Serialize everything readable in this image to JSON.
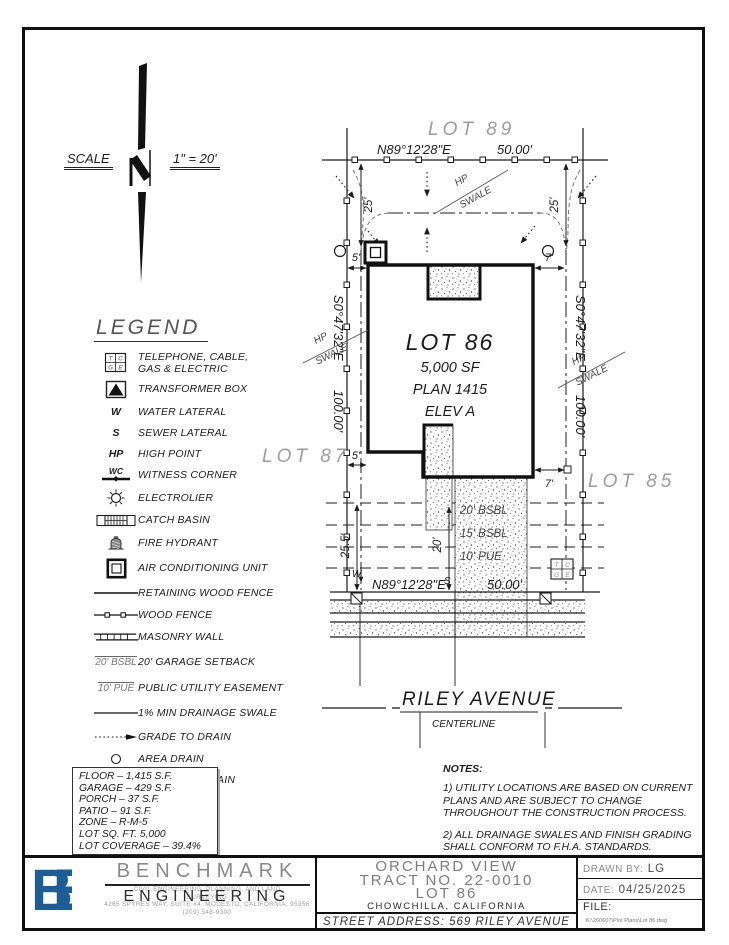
{
  "scale": {
    "label": "SCALE",
    "value": "1\" = 20'"
  },
  "legend": {
    "title": "LEGEND",
    "items": [
      {
        "sym": [
          "T",
          "C",
          "G",
          "E"
        ],
        "label": "TELEPHONE, CABLE,\nGAS & ELECTRIC"
      },
      {
        "label": "TRANSFORMER BOX"
      },
      {
        "symbol": "W",
        "label": "WATER LATERAL"
      },
      {
        "symbol": "S",
        "label": "SEWER LATERAL"
      },
      {
        "symbol": "HP",
        "label": "HIGH POINT"
      },
      {
        "symbol": "WC",
        "label": "WITNESS CORNER"
      },
      {
        "label": "ELECTROLIER"
      },
      {
        "label": "CATCH BASIN"
      },
      {
        "label": "FIRE HYDRANT"
      },
      {
        "label": "AIR CONDITIONING UNIT"
      },
      {
        "label": "RETAINING WOOD FENCE"
      },
      {
        "label": "WOOD FENCE"
      },
      {
        "label": "MASONRY WALL"
      },
      {
        "symbol": "20' BSBL",
        "label": "20' GARAGE SETBACK"
      },
      {
        "symbol": "10' PUE",
        "label": "PUBLIC UTILITY EASEMENT"
      },
      {
        "label": "1% MIN DRAINAGE SWALE"
      },
      {
        "label": "GRADE TO DRAIN"
      },
      {
        "label": "AREA DRAIN"
      },
      {
        "label": "BUBBLE UP DRAIN"
      }
    ]
  },
  "plan": {
    "adjacent": {
      "north": "LOT 89",
      "west": "LOT 87",
      "east": "LOT 85"
    },
    "lot": {
      "name": "LOT 86",
      "area": "5,000 SF",
      "plan_no": "PLAN 1415",
      "elevation": "ELEV A"
    },
    "rear": {
      "bearing": "N89°12'28\"E",
      "distance": "50.00'"
    },
    "front": {
      "bearing": "N89°12'28\"E",
      "distance": "50.00'"
    },
    "west": {
      "bearing": "S0°47'32\"E",
      "distance": "100.00'"
    },
    "east": {
      "bearing": "S0°47'32\"E",
      "distance": "100.00'"
    },
    "dims": {
      "rear_offset": "25'",
      "side_left": "5'",
      "side_right": "7'",
      "front_left": "25.5'",
      "driveway": "20'"
    },
    "setbacks": [
      "20' BSBL",
      "15' BSBL",
      "10' PUE"
    ],
    "hp": "HP",
    "swale": "SWALE",
    "utilities": {
      "water": "W",
      "sewer": "S"
    },
    "street": {
      "name": "RILEY AVENUE",
      "sublabel": "CENTERLINE"
    }
  },
  "stats": {
    "rows": [
      "FLOOR – 1,415 S.F.",
      "GARAGE – 429 S.F.",
      "PORCH – 37 S.F.",
      "PATIO – 91 S.F.",
      "ZONE – R-M-5",
      "LOT SQ. FT. 5,000",
      "LOT COVERAGE – 39.4%"
    ]
  },
  "notes": {
    "title": "NOTES:",
    "items": [
      "1) UTILITY LOCATIONS ARE BASED ON CURRENT PLANS AND ARE SUBJECT TO CHANGE THROUGHOUT THE CONSTRUCTION PROCESS.",
      "2) ALL DRAINAGE SWALES AND FINISH GRADING SHALL CONFORM TO F.H.A. STANDARDS."
    ]
  },
  "titleblock": {
    "company": {
      "logo": "BE",
      "logo_color": "#1d5d95",
      "name": "BENCHMARK",
      "overlay": "ENGINEERING",
      "line1": "CIVIL ENGINEERING, PLANNING, AND LAND",
      "line2": "SURVEYING",
      "address": "4265 SPYRES WAY, SUITE #4, MODESTO, CALIFORNIA, 95356",
      "phone": "(209) 548-9300"
    },
    "project": {
      "name": "ORCHARD VIEW",
      "tract": "TRACT NO. 22-0010",
      "lot": "LOT 86",
      "city": "CHOWCHILLA,      CALIFORNIA",
      "street": "STREET   ADDRESS:  569  RILEY  AVENUE"
    },
    "meta": {
      "drawn_label": "DRAWN BY:",
      "drawn_value": "LG",
      "date_label": "DATE:",
      "date_value": "04/25/2025",
      "file_label": "FILE:",
      "file_path": "K:\\260607\\Plot Plans\\Lot 86.dwg"
    }
  }
}
